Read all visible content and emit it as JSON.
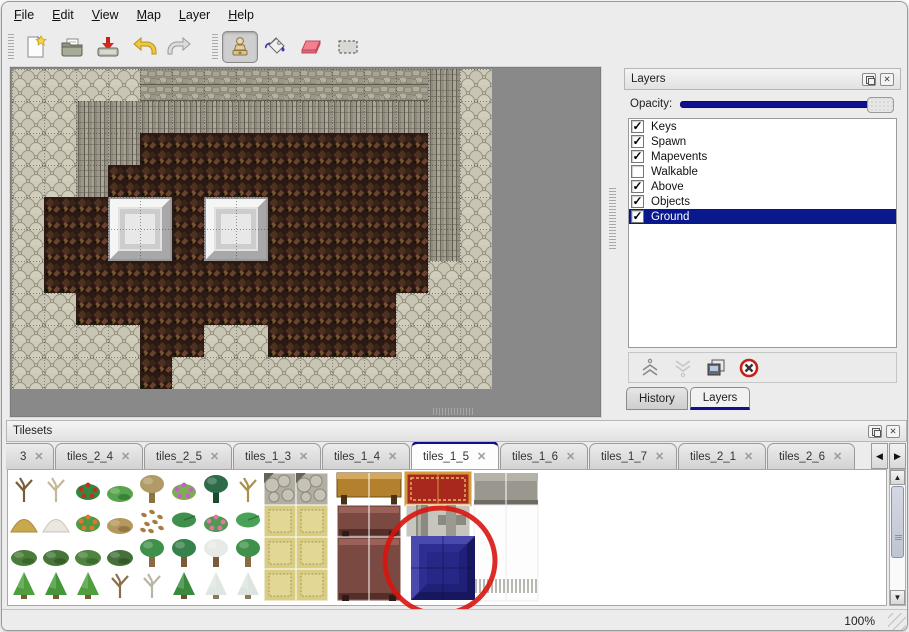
{
  "menu": {
    "items": [
      "File",
      "Edit",
      "View",
      "Map",
      "Layer",
      "Help"
    ]
  },
  "toolbar": {
    "tools": [
      {
        "name": "new"
      },
      {
        "name": "open"
      },
      {
        "name": "save"
      },
      {
        "name": "undo"
      },
      {
        "name": "redo"
      },
      {
        "name": "stamp",
        "active": true
      },
      {
        "name": "fill"
      },
      {
        "name": "eraser"
      },
      {
        "name": "select"
      }
    ]
  },
  "layers_panel": {
    "title": "Layers",
    "opacity_label": "Opacity:",
    "opacity_value_fraction": 1.0,
    "layers": [
      {
        "name": "Keys",
        "checked": true,
        "selected": false
      },
      {
        "name": "Spawn",
        "checked": true,
        "selected": false
      },
      {
        "name": "Mapevents",
        "checked": true,
        "selected": false
      },
      {
        "name": "Walkable",
        "checked": false,
        "selected": false
      },
      {
        "name": "Above",
        "checked": true,
        "selected": false
      },
      {
        "name": "Objects",
        "checked": true,
        "selected": false
      },
      {
        "name": "Ground",
        "checked": true,
        "selected": true
      }
    ],
    "tabs": [
      {
        "label": "History",
        "active": false
      },
      {
        "label": "Layers",
        "active": true
      }
    ]
  },
  "tilesets_panel": {
    "title": "Tilesets",
    "tabs": [
      {
        "label": "3",
        "active": false,
        "partial": true
      },
      {
        "label": "tiles_2_4",
        "active": false
      },
      {
        "label": "tiles_2_5",
        "active": false
      },
      {
        "label": "tiles_1_3",
        "active": false
      },
      {
        "label": "tiles_1_4",
        "active": false
      },
      {
        "label": "tiles_1_5",
        "active": true
      },
      {
        "label": "tiles_1_6",
        "active": false
      },
      {
        "label": "tiles_1_7",
        "active": false
      },
      {
        "label": "tiles_2_1",
        "active": false
      },
      {
        "label": "tiles_2_6",
        "active": false
      }
    ]
  },
  "status_bar": {
    "zoom_level": "100%"
  },
  "icons": {
    "close_glyph": "✕",
    "tab_close_glyph": "✕",
    "check_glyph": "✓",
    "left_arrow": "◀",
    "right_arrow": "▶",
    "up_arrow": "▲",
    "down_arrow": "▼"
  },
  "map": {
    "tile_size": 32,
    "rows": [
      "SSSSTTTTTTTTTCS",
      "SSCCCCCCCCCCCCS",
      "SSCCBBBBBBBBBCS",
      "SSCBBBBBBBBBBCS",
      "SBBBBBBBBBBBBCS",
      "SBBBBBBBBBBBBCS",
      "SBBBBBBBBBBBBSS",
      "SSBBBBBBBBBBSSS",
      "SSSSBBSSBBBBSSS",
      "SSSSBSSSSSSSSSS"
    ],
    "pillars": [
      {
        "col": 3,
        "row": 4
      },
      {
        "col": 6,
        "row": 4
      }
    ]
  },
  "tileset_content": {
    "plants": [
      [
        [
          "twig",
          "#7a5c38",
          ""
        ],
        [
          "twig",
          "#c4b896",
          ""
        ],
        [
          "flower",
          "#2f8a3f",
          "#c23020"
        ],
        [
          "bush",
          "#58a44c",
          "#2f7a33"
        ],
        [
          "blob",
          "#b09a66",
          "#8a7446"
        ],
        [
          "flower",
          "#7fae4e",
          "#c45fd0"
        ],
        [
          "blob",
          "#2e6b48",
          "#1c4a30"
        ],
        [
          "twig",
          "#a8904e",
          ""
        ]
      ],
      [
        [
          "mound",
          "#c9a94e",
          "#a8883a"
        ],
        [
          "mound",
          "#e9e7df",
          "#c8c6bc"
        ],
        [
          "flower",
          "#4e9a44",
          "#e87428"
        ],
        [
          "bush",
          "#b4985c",
          "#8a7040"
        ],
        [
          "dots",
          "#a87c3e",
          ""
        ],
        [
          "pad",
          "#3f8f4d",
          "#2e7038"
        ],
        [
          "flower",
          "#4e9a50",
          "#e873a6"
        ],
        [
          "pad",
          "#49a257",
          "#327840"
        ]
      ],
      [
        [
          "bush",
          "#4a7c3a",
          "#36602a"
        ],
        [
          "bush",
          "#46763a",
          "#335828"
        ],
        [
          "bush",
          "#4e8440",
          "#3a6630"
        ],
        [
          "bush",
          "#45703a",
          "#325426"
        ],
        [
          "blob",
          "#3f9048",
          "#8a6a42"
        ],
        [
          "blob",
          "#35824a",
          "#7a5c38"
        ],
        [
          "blob",
          "#e7ebe8",
          "#7a5c38"
        ],
        [
          "blob",
          "#3f9048",
          "#8a6a42"
        ]
      ],
      [
        [
          "cone",
          "#4e9e3e",
          "#7a5a36"
        ],
        [
          "cone",
          "#459638",
          "#7a5a36"
        ],
        [
          "cone",
          "#4e9e3e",
          "#7a5a36"
        ],
        [
          "twig",
          "#8a6e48",
          ""
        ],
        [
          "twig",
          "#bcb4a4",
          ""
        ],
        [
          "cone",
          "#3a8a3e",
          "#6a4e2e"
        ],
        [
          "cone",
          "#e0e6e1",
          "#8a7a5a"
        ],
        [
          "cone",
          "#dde4df",
          "#8a7a5a"
        ]
      ]
    ],
    "furniture": [
      {
        "type": "cobble",
        "x": 256,
        "y": 3,
        "w": 32,
        "h": 32
      },
      {
        "type": "cobble",
        "x": 288,
        "y": 3,
        "w": 32,
        "h": 32
      },
      {
        "type": "khaki",
        "x": 256,
        "y": 35,
        "w": 32,
        "h": 32
      },
      {
        "type": "khaki",
        "x": 288,
        "y": 35,
        "w": 32,
        "h": 32
      },
      {
        "type": "khaki",
        "x": 256,
        "y": 67,
        "w": 32,
        "h": 32
      },
      {
        "type": "khaki",
        "x": 288,
        "y": 67,
        "w": 32,
        "h": 32
      },
      {
        "type": "khaki",
        "x": 256,
        "y": 99,
        "w": 32,
        "h": 32
      },
      {
        "type": "khaki",
        "x": 288,
        "y": 99,
        "w": 32,
        "h": 32
      },
      {
        "type": "table",
        "x": 329,
        "y": 3,
        "w": 64,
        "h": 32
      },
      {
        "type": "carpet",
        "x": 398,
        "y": 3,
        "w": 64,
        "h": 32
      },
      {
        "type": "stoneblock",
        "x": 466,
        "y": 3,
        "w": 64,
        "h": 32
      },
      {
        "type": "maroon",
        "x": 329,
        "y": 35,
        "w": 64,
        "h": 32
      },
      {
        "type": "beams",
        "x": 398,
        "y": 35,
        "w": 64,
        "h": 32
      },
      {
        "type": "whitefringe",
        "x": 466,
        "y": 35,
        "w": 32,
        "h": 96
      },
      {
        "type": "whitefringe",
        "x": 498,
        "y": 35,
        "w": 32,
        "h": 96
      },
      {
        "type": "maroon",
        "x": 329,
        "y": 67,
        "w": 64,
        "h": 64
      },
      {
        "type": "bluetile",
        "x": 403,
        "y": 66,
        "w": 64,
        "h": 64
      }
    ],
    "annotation": {
      "shape": "ellipse",
      "cx": 432,
      "cy": 91,
      "rx": 55,
      "ry": 53,
      "rotate": -6,
      "color": "#d81510",
      "stroke_width": 5
    }
  },
  "colors": {
    "accent_navy": "#10108e",
    "selection_bg": "#0a188e",
    "annotation_red": "#d81510"
  }
}
